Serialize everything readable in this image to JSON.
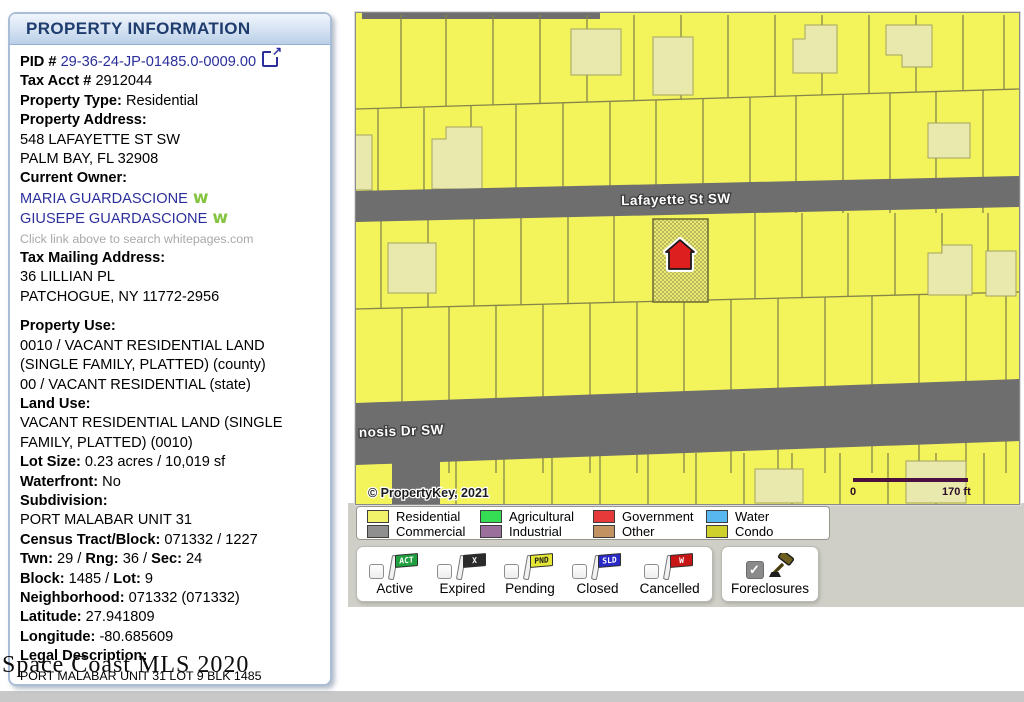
{
  "panel": {
    "title": "PROPERTY INFORMATION",
    "fields": [
      {
        "name": "pid-line",
        "segments": [
          {
            "text": "PID #  ",
            "kind": "label"
          },
          {
            "text": "29-36-24-JP-01485.0-0009.00",
            "kind": "link",
            "name": "pid-link"
          }
        ],
        "icon": "external-link-icon"
      },
      {
        "name": "tax-acct-line",
        "segments": [
          {
            "text": "Tax Acct # ",
            "kind": "label"
          },
          {
            "text": "2912044",
            "kind": "value"
          }
        ]
      },
      {
        "name": "property-type-line",
        "segments": [
          {
            "text": "Property Type:  ",
            "kind": "label"
          },
          {
            "text": "Residential",
            "kind": "value"
          }
        ]
      },
      {
        "name": "property-address-label",
        "segments": [
          {
            "text": "Property Address:",
            "kind": "label"
          }
        ]
      },
      {
        "name": "property-address-1",
        "segments": [
          {
            "text": "548 LAFAYETTE ST SW",
            "kind": "value"
          }
        ]
      },
      {
        "name": "property-address-2",
        "segments": [
          {
            "text": "PALM BAY, FL 32908",
            "kind": "value"
          }
        ]
      },
      {
        "name": "current-owner-label",
        "segments": [
          {
            "text": "Current Owner:",
            "kind": "label"
          }
        ]
      },
      {
        "name": "owner-1",
        "segments": [
          {
            "text": "MARIA GUARDASCIONE",
            "kind": "link",
            "name": "owner-maria-link"
          }
        ],
        "icon": "whitepages-icon"
      },
      {
        "name": "owner-2",
        "segments": [
          {
            "text": "GIUSEPE GUARDASCIONE",
            "kind": "link",
            "name": "owner-giusepe-link"
          }
        ],
        "icon": "whitepages-icon"
      },
      {
        "name": "whitepages-hint",
        "segments": [
          {
            "text": "Click link above to search whitepages.com",
            "kind": "hint"
          }
        ]
      },
      {
        "name": "tax-mailing-label",
        "segments": [
          {
            "text": "Tax Mailing Address:",
            "kind": "label"
          }
        ]
      },
      {
        "name": "mailing-address-1",
        "segments": [
          {
            "text": "36 LILLIAN PL",
            "kind": "value"
          }
        ]
      },
      {
        "name": "mailing-address-2",
        "segments": [
          {
            "text": "PATCHOGUE, NY 11772-2956",
            "kind": "value"
          }
        ]
      },
      {
        "name": "property-use-label",
        "gap_before": true,
        "segments": [
          {
            "text": "Property Use:",
            "kind": "label"
          }
        ]
      },
      {
        "name": "property-use-1",
        "segments": [
          {
            "text": "0010 / VACANT RESIDENTIAL LAND",
            "kind": "value"
          }
        ]
      },
      {
        "name": "property-use-2",
        "segments": [
          {
            "text": "(SINGLE FAMILY, PLATTED) (county)",
            "kind": "value"
          }
        ]
      },
      {
        "name": "property-use-3",
        "segments": [
          {
            "text": "00 / VACANT RESIDENTIAL (state)",
            "kind": "value"
          }
        ]
      },
      {
        "name": "land-use-label",
        "segments": [
          {
            "text": "Land Use:",
            "kind": "label"
          }
        ]
      },
      {
        "name": "land-use-1",
        "segments": [
          {
            "text": "VACANT RESIDENTIAL LAND (SINGLE",
            "kind": "value"
          }
        ]
      },
      {
        "name": "land-use-2",
        "segments": [
          {
            "text": "FAMILY, PLATTED) (0010)",
            "kind": "value"
          }
        ]
      },
      {
        "name": "lot-size-line",
        "segments": [
          {
            "text": "Lot Size: ",
            "kind": "label"
          },
          {
            "text": "0.23 acres / 10,019 sf",
            "kind": "value"
          }
        ]
      },
      {
        "name": "waterfront-line",
        "segments": [
          {
            "text": "Waterfront: ",
            "kind": "label"
          },
          {
            "text": "No",
            "kind": "value"
          }
        ]
      },
      {
        "name": "subdivision-label",
        "segments": [
          {
            "text": "Subdivision:",
            "kind": "label"
          }
        ]
      },
      {
        "name": "subdivision-value",
        "segments": [
          {
            "text": "PORT MALABAR UNIT 31",
            "kind": "value"
          }
        ]
      },
      {
        "name": "census-line",
        "segments": [
          {
            "text": "Census Tract/Block: ",
            "kind": "label"
          },
          {
            "text": "071332 / 1227",
            "kind": "value"
          }
        ]
      },
      {
        "name": "twn-rng-sec-line",
        "segments": [
          {
            "text": "Twn: ",
            "kind": "label"
          },
          {
            "text": "29 / ",
            "kind": "value"
          },
          {
            "text": "Rng: ",
            "kind": "label"
          },
          {
            "text": "36 / ",
            "kind": "value"
          },
          {
            "text": "Sec: ",
            "kind": "label"
          },
          {
            "text": "24",
            "kind": "value"
          }
        ]
      },
      {
        "name": "block-lot-line",
        "segments": [
          {
            "text": "Block: ",
            "kind": "label"
          },
          {
            "text": "1485 / ",
            "kind": "value"
          },
          {
            "text": "Lot: ",
            "kind": "label"
          },
          {
            "text": "9",
            "kind": "value"
          }
        ]
      },
      {
        "name": "neighborhood-line",
        "segments": [
          {
            "text": "Neighborhood: ",
            "kind": "label"
          },
          {
            "text": "071332 (071332)",
            "kind": "value"
          }
        ]
      },
      {
        "name": "latitude-line",
        "segments": [
          {
            "text": "Latitude: ",
            "kind": "label"
          },
          {
            "text": "27.941809",
            "kind": "value"
          }
        ]
      },
      {
        "name": "longitude-line",
        "segments": [
          {
            "text": "Longitude: ",
            "kind": "label"
          },
          {
            "text": "-80.685609",
            "kind": "value"
          }
        ]
      },
      {
        "name": "legal-description-label",
        "segments": [
          {
            "text": "Legal Description:",
            "kind": "label"
          }
        ]
      },
      {
        "name": "legal-description-value",
        "segments": [
          {
            "text": "PORT MALABAR UNIT 31 LOT 9 BLK 1485",
            "kind": "small"
          }
        ]
      }
    ]
  },
  "watermark": "Space Coast MLS 2020",
  "map": {
    "street1": "Lafayette St SW",
    "street2": "nosis Dr SW",
    "attribution": "© PropertyKey, 2021",
    "scale_start": "0",
    "scale_end": "170 ft"
  },
  "legend": {
    "items": [
      {
        "label": "Residential",
        "color": "#f2f26a"
      },
      {
        "label": "Commercial",
        "color": "#8f8f8f"
      },
      {
        "label": "Agricultural",
        "color": "#35dd55"
      },
      {
        "label": "Industrial",
        "color": "#9b6f9b"
      },
      {
        "label": "Government",
        "color": "#e63939"
      },
      {
        "label": "Other",
        "color": "#c29263"
      },
      {
        "label": "Water",
        "color": "#58b7ee"
      },
      {
        "label": "Condo",
        "color": "#cfd02b"
      }
    ]
  },
  "filters": {
    "items": [
      {
        "label": "Active",
        "flag_text": "ACT",
        "flag_color": "#1fa03f",
        "flag_text_color": "#ffffff",
        "checked": false
      },
      {
        "label": "Expired",
        "flag_text": "X",
        "flag_color": "#2b2b2b",
        "flag_text_color": "#ffffff",
        "checked": false
      },
      {
        "label": "Pending",
        "flag_text": "PND",
        "flag_color": "#e6e635",
        "flag_text_color": "#222222",
        "checked": false
      },
      {
        "label": "Closed",
        "flag_text": "SLD",
        "flag_color": "#2929c8",
        "flag_text_color": "#ffffff",
        "checked": false
      },
      {
        "label": "Cancelled",
        "flag_text": "W",
        "flag_color": "#c81616",
        "flag_text_color": "#ffffff",
        "checked": false
      }
    ],
    "foreclosures": {
      "label": "Foreclosures",
      "checked": true
    }
  },
  "icons": {
    "checkmark": "✓",
    "whitepages": "w",
    "external_link": "↗"
  }
}
